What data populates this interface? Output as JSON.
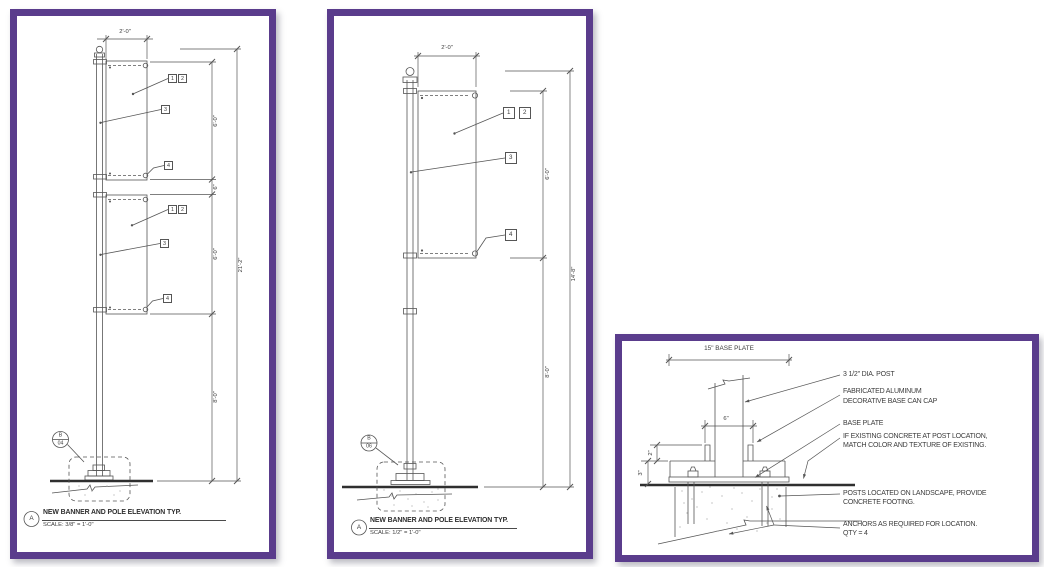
{
  "colors": {
    "frame": "#5a3c8c",
    "line": "#555555",
    "text": "#3c3c3c"
  },
  "left": {
    "dims": {
      "width": "2'-0\"",
      "banner_top": "6'-0\"",
      "gap": "6\"",
      "banner_bottom": "6'-0\"",
      "pole_below": "8'-0\"",
      "overall": "21'-2\""
    },
    "callouts": {
      "c1": "1",
      "c2": "2",
      "c3": "3",
      "c4": "4"
    },
    "marker": {
      "letter": "B",
      "number": "04"
    },
    "view": {
      "letter": "A",
      "title": "NEW BANNER AND POLE ELEVATION TYP.",
      "scale": "SCALE: 3/8\" = 1'-0\""
    }
  },
  "middle": {
    "dims": {
      "width": "2'-0\"",
      "banner": "6'-0\"",
      "pole_below": "8'-0\"",
      "overall": "14'-8\""
    },
    "callouts": {
      "c1": "1",
      "c2": "2",
      "c3": "3",
      "c4": "4"
    },
    "marker": {
      "letter": "B",
      "number": "06"
    },
    "view": {
      "letter": "A",
      "title": "NEW BANNER AND POLE ELEVATION TYP.",
      "scale": "SCALE: 1/2\" = 1'-0\""
    }
  },
  "detail": {
    "dims": {
      "base_plate": "15\" BASE PLATE",
      "can_width": "6\"",
      "cap_height": "2\"",
      "base_height": "3\""
    },
    "notes": {
      "post": "3 1/2\" DIA. POST",
      "cap_line1": "FABRICATED ALUMINUM",
      "cap_line2": "DECORATIVE BASE CAN CAP",
      "plate": "BASE PLATE",
      "existing_line1": "IF EXISTING CONCRETE AT POST LOCATION,",
      "existing_line2": "MATCH COLOR AND TEXTURE OF EXISTING.",
      "footing_line1": "POSTS LOCATED ON LANDSCAPE, PROVIDE",
      "footing_line2": "CONCRETE FOOTING.",
      "anchors_line1": "ANCHORS AS REQUIRED FOR LOCATION.",
      "anchors_line2": "QTY = 4"
    }
  }
}
